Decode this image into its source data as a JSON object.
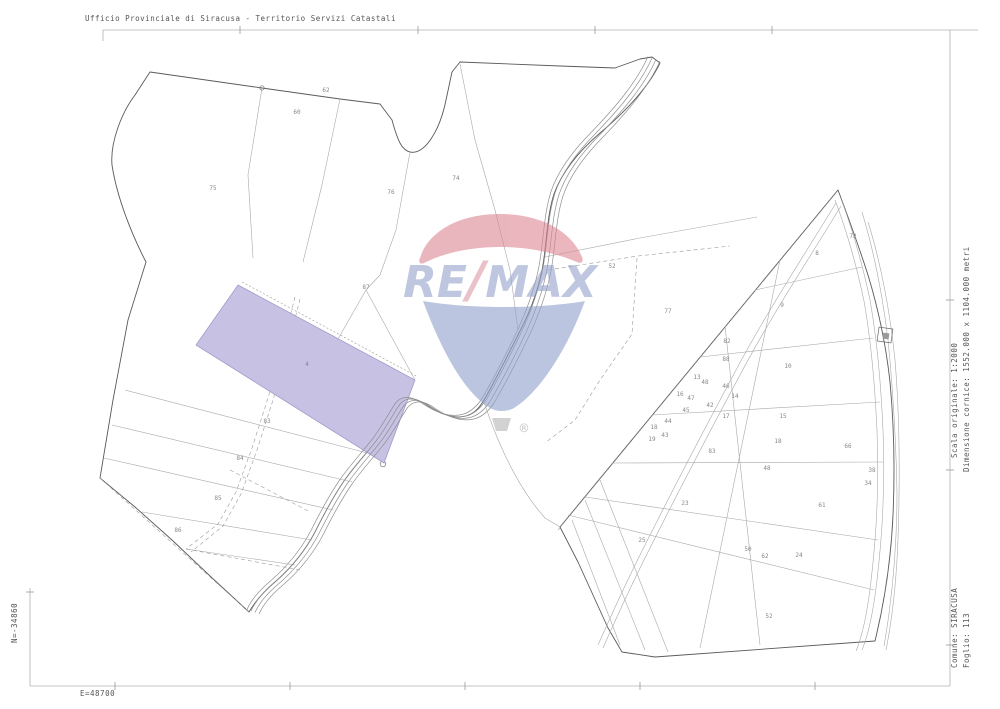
{
  "header": {
    "title": "Ufficio Provinciale di Siracusa - Territorio Servizi Catastali"
  },
  "right_margin": {
    "scale_label": "Scala originale: 1:2000",
    "frame_size_label": "Dimensione cornice: 1552.000 x 1104.000 metri"
  },
  "sheet_info": {
    "comune_label": "Comune: SIRACUSA",
    "foglio_label": "Foglio: 113"
  },
  "coordinates": {
    "north_label": "N=-34860",
    "east_label": "E=48700"
  },
  "watermark": {
    "brand": "RE/MAX",
    "re": "RE",
    "slash": "/",
    "max": "MAX",
    "registered": "®",
    "colors": {
      "balloon_red": "#dd8693",
      "balloon_blue": "#8fa0ca",
      "text_blue": "#93a3cb",
      "text_red": "#dd98a4"
    }
  },
  "map": {
    "highlight_color": "#c7c1e4",
    "highlighted_parcel": {
      "number": "4"
    },
    "parcel_numbers": [
      {
        "n": "75",
        "x": 213,
        "y": 190
      },
      {
        "n": "60",
        "x": 297,
        "y": 114
      },
      {
        "n": "62",
        "x": 326,
        "y": 92
      },
      {
        "n": "76",
        "x": 391,
        "y": 194
      },
      {
        "n": "74",
        "x": 456,
        "y": 180
      },
      {
        "n": "87",
        "x": 366,
        "y": 289
      },
      {
        "n": "4",
        "x": 307,
        "y": 366
      },
      {
        "n": "83",
        "x": 267,
        "y": 423
      },
      {
        "n": "84",
        "x": 240,
        "y": 460
      },
      {
        "n": "85",
        "x": 218,
        "y": 500
      },
      {
        "n": "86",
        "x": 178,
        "y": 532
      },
      {
        "n": "52",
        "x": 612,
        "y": 268
      },
      {
        "n": "77",
        "x": 668,
        "y": 313
      },
      {
        "n": "72",
        "x": 853,
        "y": 238
      },
      {
        "n": "8",
        "x": 817,
        "y": 255
      },
      {
        "n": "9",
        "x": 782,
        "y": 307
      },
      {
        "n": "10",
        "x": 788,
        "y": 368
      },
      {
        "n": "82",
        "x": 727,
        "y": 343
      },
      {
        "n": "88",
        "x": 726,
        "y": 361
      },
      {
        "n": "13",
        "x": 697,
        "y": 379
      },
      {
        "n": "48",
        "x": 705,
        "y": 384
      },
      {
        "n": "46",
        "x": 726,
        "y": 388
      },
      {
        "n": "16",
        "x": 680,
        "y": 396
      },
      {
        "n": "47",
        "x": 691,
        "y": 400
      },
      {
        "n": "14",
        "x": 735,
        "y": 398
      },
      {
        "n": "42",
        "x": 710,
        "y": 407
      },
      {
        "n": "45",
        "x": 686,
        "y": 412
      },
      {
        "n": "17",
        "x": 726,
        "y": 418
      },
      {
        "n": "15",
        "x": 783,
        "y": 418
      },
      {
        "n": "44",
        "x": 668,
        "y": 423
      },
      {
        "n": "18",
        "x": 654,
        "y": 429
      },
      {
        "n": "43",
        "x": 665,
        "y": 437
      },
      {
        "n": "19",
        "x": 652,
        "y": 441
      },
      {
        "n": "83",
        "x": 712,
        "y": 453
      },
      {
        "n": "18",
        "x": 778,
        "y": 443
      },
      {
        "n": "48",
        "x": 767,
        "y": 470
      },
      {
        "n": "66",
        "x": 848,
        "y": 448
      },
      {
        "n": "34",
        "x": 868,
        "y": 485
      },
      {
        "n": "38",
        "x": 872,
        "y": 472
      },
      {
        "n": "23",
        "x": 685,
        "y": 505
      },
      {
        "n": "61",
        "x": 822,
        "y": 507
      },
      {
        "n": "25",
        "x": 642,
        "y": 542
      },
      {
        "n": "50",
        "x": 748,
        "y": 551
      },
      {
        "n": "24",
        "x": 799,
        "y": 557
      },
      {
        "n": "62",
        "x": 765,
        "y": 558
      },
      {
        "n": "52",
        "x": 769,
        "y": 618
      }
    ]
  }
}
